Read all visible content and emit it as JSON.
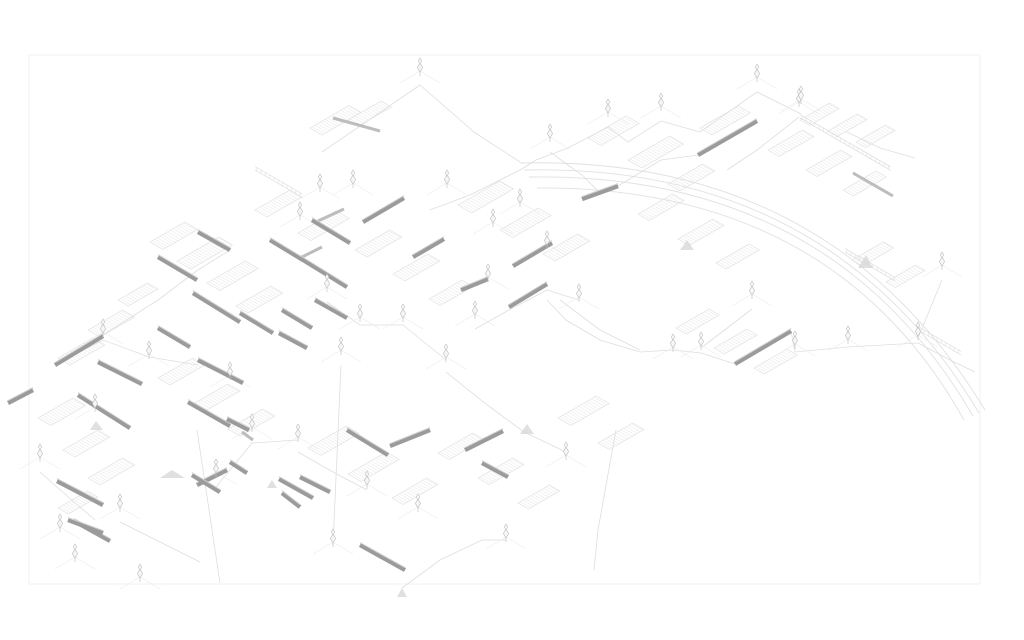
{
  "page": {
    "background": "#ffffff",
    "description": "axonometric-structure-drawing"
  },
  "drawing": {
    "canvas": {
      "width": 1024,
      "height": 640
    },
    "frame": {
      "x": 29,
      "y": 55,
      "width": 951,
      "height": 529
    },
    "palette": {
      "frame": "#f2f2f2",
      "arc": "#e1e1e1",
      "link": "#dedede",
      "platform_outline": "#e0e0e0",
      "platform_hatch": "#e4e4e4",
      "ladder": "#dcdcdc",
      "guy": "#ececec",
      "beam": "#9b9b9b",
      "beam_top": "#cfcfcf",
      "beam_light": "#bdbdbd",
      "tower": "#c2c2c2",
      "tower_fill": "#f6f6f6",
      "gusset": "#d6d6d6"
    },
    "arcs": [
      "M520,163 Q830,155 985,410",
      "M524,170 Q830,163 979,413",
      "M529,177 Q831,172 973,416",
      "M537,188 Q833,186 964,420"
    ],
    "beams": [
      [
        698,
        155,
        757,
        121
      ],
      [
        582,
        199,
        618,
        186
      ],
      [
        363,
        222,
        404,
        198
      ],
      [
        413,
        257,
        444,
        239
      ],
      [
        513,
        266,
        552,
        243
      ],
      [
        461,
        290,
        488,
        279
      ],
      [
        509,
        307,
        547,
        284
      ],
      [
        55,
        365,
        103,
        336
      ],
      [
        197,
        485,
        227,
        470
      ],
      [
        390,
        446,
        430,
        430
      ],
      [
        465,
        450,
        503,
        431
      ],
      [
        735,
        364,
        791,
        331
      ],
      [
        8,
        403,
        33,
        390
      ],
      [
        158,
        257,
        197,
        280
      ],
      [
        198,
        232,
        230,
        250
      ],
      [
        270,
        240,
        303,
        260
      ],
      [
        300,
        258,
        347,
        287
      ],
      [
        312,
        220,
        350,
        243
      ],
      [
        193,
        293,
        240,
        322
      ],
      [
        240,
        313,
        273,
        333
      ],
      [
        282,
        310,
        312,
        328
      ],
      [
        315,
        300,
        347,
        318
      ],
      [
        158,
        328,
        190,
        347
      ],
      [
        98,
        362,
        142,
        384
      ],
      [
        78,
        395,
        130,
        428
      ],
      [
        57,
        481,
        103,
        505
      ],
      [
        198,
        360,
        243,
        383
      ],
      [
        188,
        402,
        230,
        426
      ],
      [
        279,
        333,
        307,
        348
      ],
      [
        227,
        419,
        249,
        430
      ],
      [
        279,
        479,
        313,
        498
      ],
      [
        74,
        521,
        110,
        541
      ],
      [
        347,
        430,
        388,
        455
      ],
      [
        300,
        477,
        330,
        492
      ],
      [
        360,
        545,
        405,
        570
      ],
      [
        482,
        463,
        508,
        477
      ],
      [
        68,
        520,
        103,
        533
      ],
      [
        230,
        462,
        247,
        473
      ],
      [
        282,
        493,
        300,
        507
      ],
      [
        192,
        475,
        220,
        492
      ]
    ],
    "beams_light": [
      [
        333,
        118,
        380,
        131
      ],
      [
        853,
        173,
        893,
        196
      ],
      [
        242,
        432,
        253,
        440
      ],
      [
        318,
        221,
        344,
        209
      ],
      [
        300,
        258,
        322,
        247
      ]
    ],
    "towers": [
      [
        420,
        74
      ],
      [
        757,
        80
      ],
      [
        799,
        105
      ],
      [
        942,
        268
      ],
      [
        608,
        115
      ],
      [
        550,
        140
      ],
      [
        661,
        109
      ],
      [
        801,
        102
      ],
      [
        320,
        190
      ],
      [
        353,
        186
      ],
      [
        447,
        186
      ],
      [
        493,
        225
      ],
      [
        547,
        247
      ],
      [
        488,
        280
      ],
      [
        475,
        317
      ],
      [
        446,
        360
      ],
      [
        403,
        320
      ],
      [
        360,
        320
      ],
      [
        341,
        353
      ],
      [
        327,
        290
      ],
      [
        300,
        218
      ],
      [
        520,
        205
      ],
      [
        579,
        300
      ],
      [
        103,
        335
      ],
      [
        149,
        357
      ],
      [
        230,
        378
      ],
      [
        252,
        430
      ],
      [
        298,
        440
      ],
      [
        216,
        475
      ],
      [
        120,
        510
      ],
      [
        60,
        530
      ],
      [
        95,
        410
      ],
      [
        40,
        460
      ],
      [
        75,
        560
      ],
      [
        140,
        580
      ],
      [
        333,
        545
      ],
      [
        367,
        487
      ],
      [
        418,
        510
      ],
      [
        506,
        540
      ],
      [
        566,
        458
      ],
      [
        673,
        350
      ],
      [
        701,
        348
      ],
      [
        795,
        347
      ],
      [
        848,
        342
      ],
      [
        918,
        338
      ],
      [
        752,
        297
      ]
    ],
    "platforms": [
      [
        310,
        128,
        45,
        14
      ],
      [
        348,
        120,
        38,
        12
      ],
      [
        255,
        210,
        40,
        14
      ],
      [
        298,
        233,
        44,
        15
      ],
      [
        150,
        242,
        40,
        15
      ],
      [
        177,
        261,
        48,
        16
      ],
      [
        207,
        283,
        44,
        15
      ],
      [
        236,
        306,
        40,
        14
      ],
      [
        118,
        300,
        34,
        12
      ],
      [
        88,
        330,
        40,
        14
      ],
      [
        355,
        250,
        40,
        14
      ],
      [
        393,
        274,
        40,
        14
      ],
      [
        429,
        299,
        38,
        13
      ],
      [
        458,
        205,
        48,
        16
      ],
      [
        500,
        230,
        44,
        15
      ],
      [
        543,
        254,
        40,
        14
      ],
      [
        588,
        138,
        44,
        15
      ],
      [
        628,
        160,
        48,
        16
      ],
      [
        668,
        184,
        40,
        14
      ],
      [
        700,
        128,
        44,
        14
      ],
      [
        768,
        150,
        40,
        13
      ],
      [
        806,
        170,
        40,
        13
      ],
      [
        843,
        190,
        38,
        12
      ],
      [
        638,
        214,
        40,
        13
      ],
      [
        678,
        239,
        40,
        13
      ],
      [
        716,
        263,
        38,
        12
      ],
      [
        58,
        358,
        40,
        14
      ],
      [
        38,
        418,
        40,
        15
      ],
      [
        63,
        450,
        40,
        14
      ],
      [
        88,
        478,
        40,
        14
      ],
      [
        58,
        508,
        34,
        12
      ],
      [
        158,
        378,
        40,
        14
      ],
      [
        193,
        404,
        40,
        14
      ],
      [
        228,
        429,
        40,
        14
      ],
      [
        308,
        448,
        44,
        15
      ],
      [
        348,
        474,
        44,
        15
      ],
      [
        392,
        498,
        40,
        13
      ],
      [
        438,
        453,
        40,
        13
      ],
      [
        478,
        478,
        40,
        13
      ],
      [
        518,
        503,
        36,
        12
      ],
      [
        558,
        418,
        44,
        15
      ],
      [
        598,
        443,
        40,
        13
      ],
      [
        676,
        328,
        38,
        12
      ],
      [
        714,
        348,
        38,
        12
      ],
      [
        754,
        368,
        38,
        12
      ],
      [
        800,
        120,
        34,
        11
      ],
      [
        828,
        131,
        34,
        11
      ],
      [
        856,
        142,
        34,
        11
      ],
      [
        852,
        260,
        36,
        12
      ],
      [
        886,
        282,
        34,
        11
      ]
    ],
    "ladders": [
      [
        800,
        118,
        105,
        1
      ],
      [
        918,
        330,
        50,
        1
      ],
      [
        845,
        252,
        58,
        1
      ],
      [
        255,
        170,
        55,
        1
      ]
    ],
    "links": [
      [
        [
          420,
          85
        ],
        [
          366,
          122
        ],
        [
          322,
          152
        ]
      ],
      [
        [
          420,
          85
        ],
        [
          474,
          132
        ],
        [
          520,
          162
        ]
      ],
      [
        [
          757,
          92
        ],
        [
          700,
          132
        ],
        [
          661,
          121
        ]
      ],
      [
        [
          757,
          92
        ],
        [
          801,
          114
        ]
      ],
      [
        [
          799,
          117
        ],
        [
          757,
          150
        ],
        [
          727,
          170
        ]
      ],
      [
        [
          608,
          127
        ],
        [
          568,
          148
        ],
        [
          536,
          160
        ],
        [
          520,
          170
        ]
      ],
      [
        [
          661,
          121
        ],
        [
          628,
          142
        ],
        [
          608,
          127
        ]
      ],
      [
        [
          520,
          170
        ],
        [
          470,
          195
        ],
        [
          430,
          210
        ]
      ],
      [
        [
          550,
          152
        ],
        [
          582,
          175
        ],
        [
          600,
          193
        ]
      ],
      [
        [
          618,
          186
        ],
        [
          661,
          160
        ],
        [
          698,
          155
        ]
      ],
      [
        [
          673,
          350
        ],
        [
          640,
          352
        ],
        [
          600,
          340
        ],
        [
          566,
          320
        ],
        [
          547,
          300
        ]
      ],
      [
        [
          791,
          331
        ],
        [
          795,
          352
        ],
        [
          848,
          347
        ],
        [
          918,
          343
        ]
      ],
      [
        [
          918,
          343
        ],
        [
          950,
          360
        ],
        [
          975,
          372
        ]
      ],
      [
        [
          735,
          364
        ],
        [
          701,
          353
        ],
        [
          673,
          350
        ]
      ],
      [
        [
          752,
          309
        ],
        [
          722,
          332
        ],
        [
          701,
          348
        ]
      ],
      [
        [
          847,
          132
        ],
        [
          880,
          148
        ],
        [
          915,
          158
        ]
      ],
      [
        [
          55,
          365
        ],
        [
          103,
          340
        ],
        [
          149,
          357
        ],
        [
          198,
          365
        ]
      ],
      [
        [
          103,
          335
        ],
        [
          158,
          300
        ],
        [
          198,
          270
        ],
        [
          230,
          250
        ]
      ],
      [
        [
          327,
          302
        ],
        [
          360,
          325
        ],
        [
          403,
          325
        ],
        [
          446,
          360
        ]
      ],
      [
        [
          341,
          365
        ],
        [
          333,
          545
        ]
      ],
      [
        [
          197,
          430
        ],
        [
          220,
          583
        ]
      ],
      [
        [
          616,
          430
        ],
        [
          598,
          530
        ],
        [
          594,
          570
        ]
      ],
      [
        [
          446,
          372
        ],
        [
          486,
          404
        ],
        [
          524,
          432
        ],
        [
          566,
          452
        ]
      ],
      [
        [
          298,
          452
        ],
        [
          333,
          472
        ],
        [
          367,
          490
        ]
      ],
      [
        [
          216,
          487
        ],
        [
          252,
          443
        ],
        [
          298,
          440
        ]
      ],
      [
        [
          120,
          522
        ],
        [
          162,
          543
        ],
        [
          200,
          562
        ]
      ],
      [
        [
          40,
          472
        ],
        [
          74,
          502
        ],
        [
          95,
          520
        ]
      ],
      [
        [
          560,
          300
        ],
        [
          600,
          330
        ],
        [
          640,
          350
        ]
      ],
      [
        [
          942,
          280
        ],
        [
          918,
          338
        ]
      ],
      [
        [
          402,
          588
        ],
        [
          440,
          560
        ],
        [
          482,
          540
        ],
        [
          506,
          540
        ]
      ],
      [
        [
          475,
          329
        ],
        [
          509,
          310
        ],
        [
          547,
          290
        ],
        [
          579,
          300
        ]
      ]
    ],
    "gussets": [
      [
        [
          858,
          268
        ],
        [
          873,
          268
        ],
        [
          866,
          255
        ]
      ],
      [
        [
          397,
          597
        ],
        [
          407,
          597
        ],
        [
          402,
          588
        ]
      ],
      [
        [
          520,
          434
        ],
        [
          534,
          434
        ],
        [
          527,
          424
        ]
      ],
      [
        [
          160,
          478
        ],
        [
          185,
          478
        ],
        [
          172,
          470
        ]
      ],
      [
        [
          680,
          250
        ],
        [
          694,
          250
        ],
        [
          687,
          240
        ]
      ],
      [
        [
          267,
          488
        ],
        [
          277,
          488
        ],
        [
          272,
          480
        ]
      ],
      [
        [
          90,
          430
        ],
        [
          103,
          430
        ],
        [
          96,
          421
        ]
      ]
    ]
  }
}
